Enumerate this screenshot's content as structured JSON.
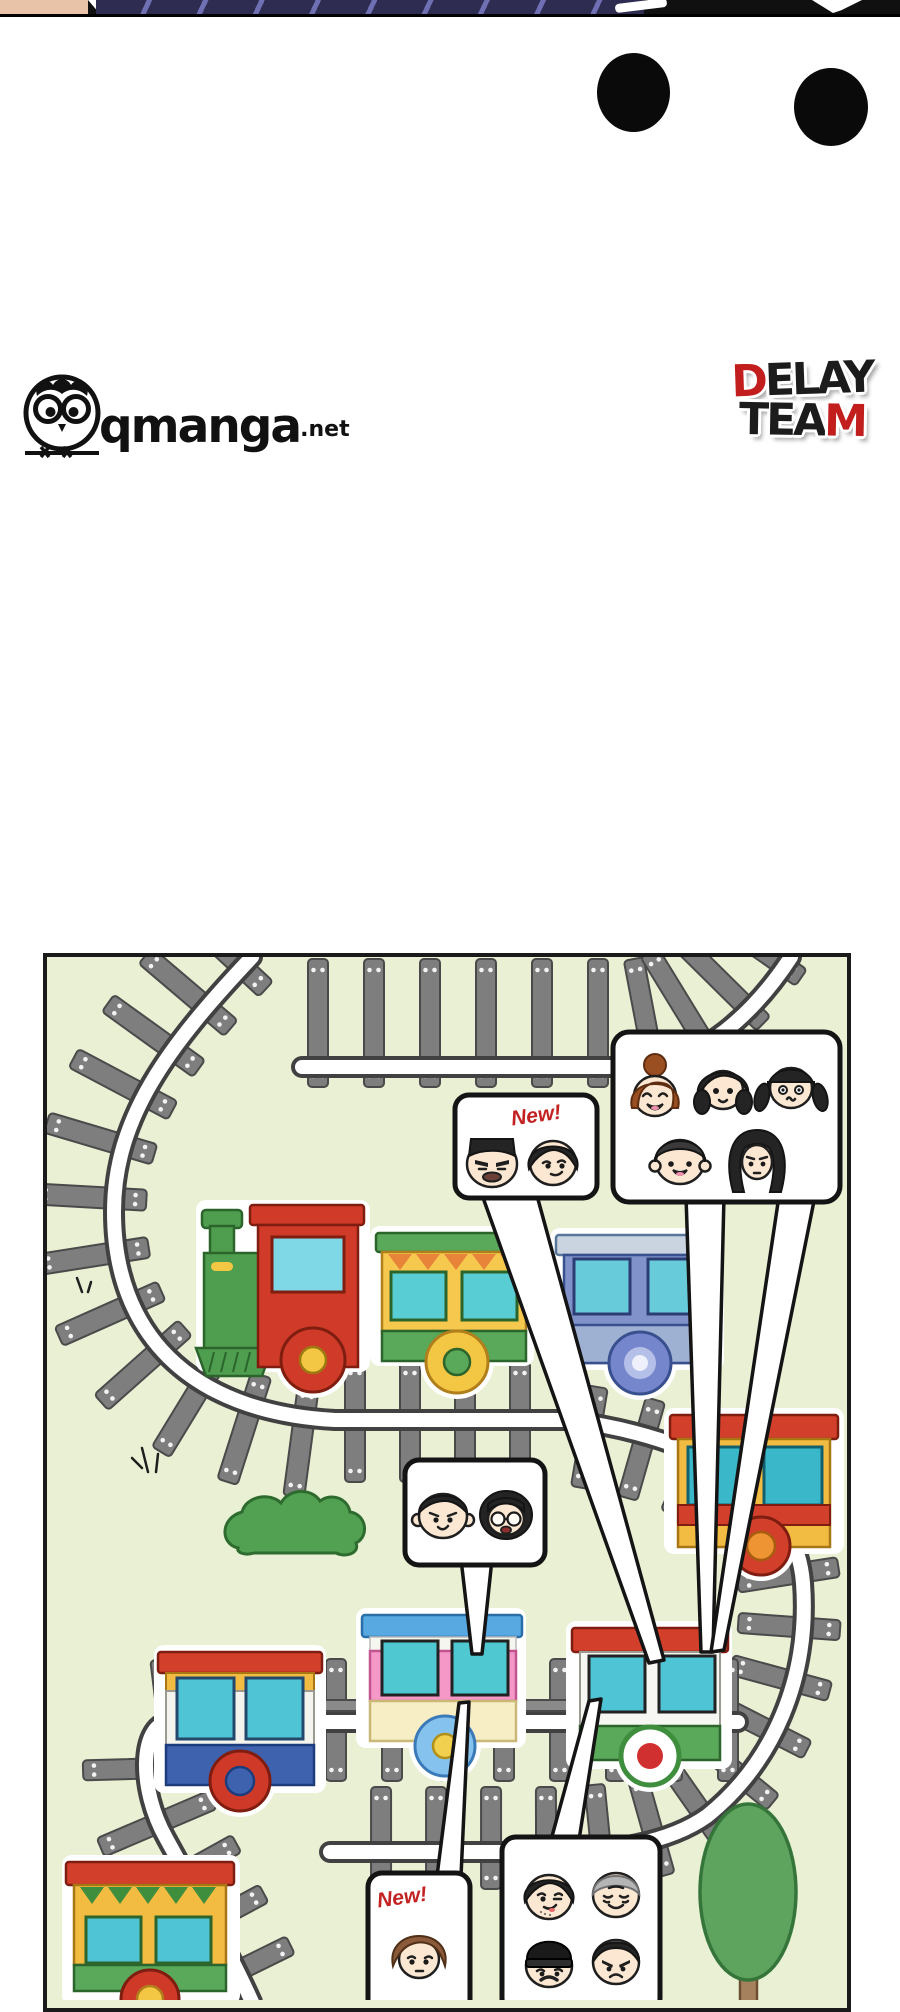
{
  "top_strip": {
    "description": "cropped bottom edge of previous comic panel",
    "skin_color": "#e9c3a7",
    "suit_color": "#2e2c50",
    "stripe_color": "#6f6fb4",
    "dark_color": "#101010"
  },
  "ellipsis": {
    "count": 2,
    "color": "#0a0a0a"
  },
  "branding": {
    "qmanga": {
      "name": "qmanga",
      "tld": ".net",
      "icon": "owl-in-circle-on-branch"
    },
    "delay_team": {
      "word1_red": "D",
      "word1_rest": "ELAY",
      "word2_rest": "TEA",
      "word2_red": "M",
      "red": "#c31e1e",
      "dark": "#1c1c1c"
    }
  },
  "panel": {
    "background": "#e9f0d4",
    "border": "#1a1a1a"
  },
  "labels": {
    "new_top": "New!",
    "new_bottom": "New!"
  },
  "trains": {
    "locomotive": {
      "body": "#cf3b28",
      "boiler": "#4f9e4f",
      "window": "#7fd8e6",
      "wheel_hub": "#f3c643"
    },
    "cars": [
      {
        "name": "green-awning-car",
        "body": "#f6c94e",
        "roof": "#5aa85a",
        "windows": "#58cdd4"
      },
      {
        "name": "blue-car",
        "body": "#8092c9",
        "roof": "#c9d4e0",
        "windows": "#68cbda"
      },
      {
        "name": "yellow-red-car",
        "body": "#f2bb41",
        "roof": "#d2402c",
        "windows": "#3ab8c9"
      },
      {
        "name": "white-blue-car",
        "body": "#f4f4ef",
        "roof": "#d2402c",
        "band": "#3f62ae",
        "windows": "#4fc4d4"
      },
      {
        "name": "pink-blue-car",
        "body": "#f598c8",
        "roof": "#58a8e2",
        "band": "#f8eec6",
        "windows": "#4fc8d2"
      },
      {
        "name": "green-white-car",
        "body": "#f6f6f2",
        "roof": "#d2402c",
        "band": "#5aa85a",
        "windows": "#4fc4d4"
      },
      {
        "name": "zigzag-yellow-car",
        "body": "#f2bb41",
        "roof": "#d2402c",
        "band": "#5aa85a",
        "windows": "#4fc4d4"
      }
    ]
  },
  "bubbles": [
    {
      "name": "new-arrivals-top",
      "label": "New!",
      "faces": [
        "man-flattop",
        "man-tousled"
      ]
    },
    {
      "name": "group-of-five",
      "faces": [
        "woman-bun",
        "woman-sidepart",
        "woman-pigtails",
        "man-bowlcut",
        "woman-longhair"
      ]
    },
    {
      "name": "pair",
      "faces": [
        "man-big-ears",
        "woman-glasses"
      ]
    },
    {
      "name": "new-arrival-bottom",
      "label": "New!",
      "faces": [
        "person-brown-shaggy"
      ]
    },
    {
      "name": "group-of-four",
      "faces": [
        "man-stubble",
        "man-gray-old",
        "man-beanie",
        "man-angry"
      ]
    }
  ],
  "scenery": {
    "bush": "#52a152",
    "tree": "#5ea35e",
    "trunk": "#a5825d",
    "track_tie": "#7e7e7e"
  }
}
